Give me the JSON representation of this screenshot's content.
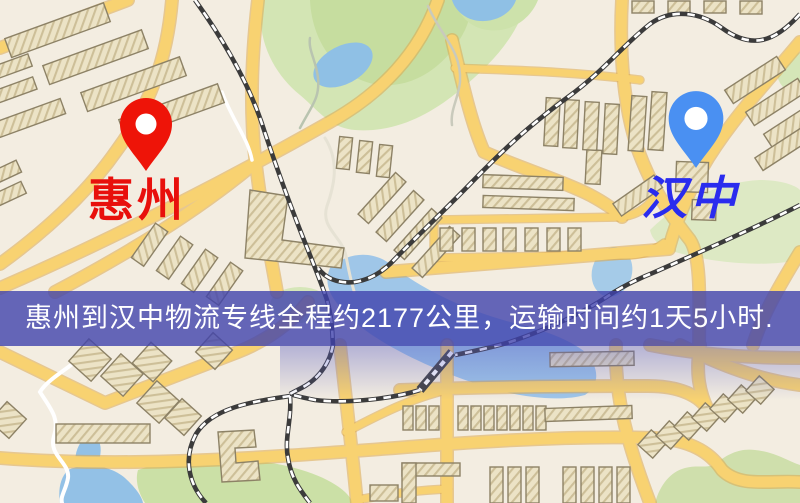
{
  "banner": {
    "text": "惠州到汉中物流专线全程约2177公里，运输时间约1天5小时.",
    "background": "#4042ac",
    "text_color": "#ffffff"
  },
  "markers": {
    "origin": {
      "name": "惠州",
      "label_color": "#e8100c",
      "pin_color": "#ee1408"
    },
    "destination": {
      "name": "汉中",
      "label_color": "#2a2cee",
      "pin_color": "#4a90f2"
    }
  },
  "map_colors": {
    "background": "#f3ede1",
    "road_major": "#f8d271",
    "road_casing": "#dca94f",
    "road_minor_white": "#ffffff",
    "park": "#cfe3ad",
    "water": "#93c1e6",
    "building_fill": "#ece3c6",
    "building_outline": "#8d8266",
    "railway": "#3b3b3b"
  }
}
